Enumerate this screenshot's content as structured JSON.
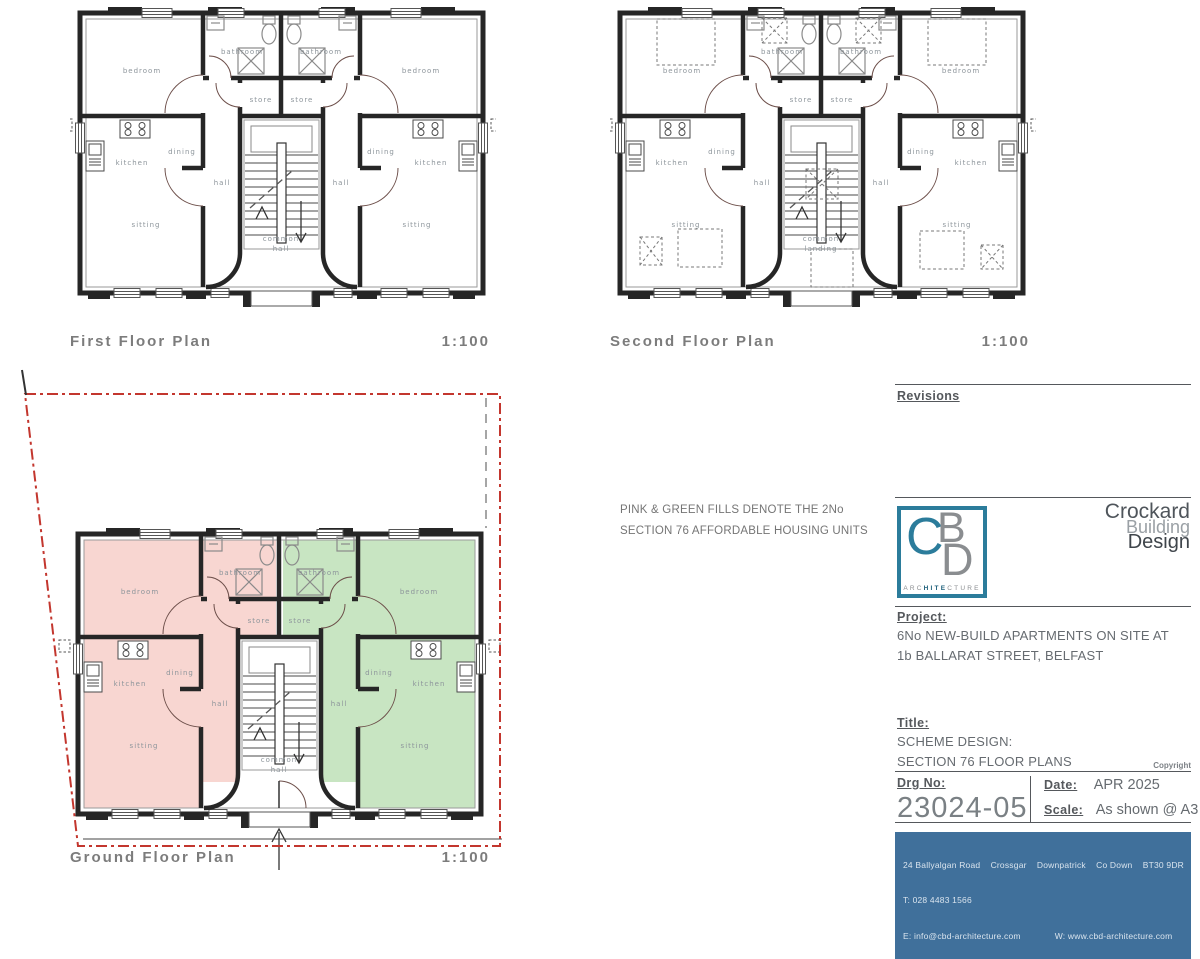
{
  "plans": {
    "first": {
      "title": "First Floor Plan",
      "scale": "1:100",
      "rooms": {
        "bedroom": "bedroom",
        "bathroom": "bathroom",
        "store": "store",
        "kitchen": "kitchen",
        "dining": "dining",
        "hall": "hall",
        "sitting": "sitting",
        "common_line1": "common",
        "common_line2": "hall"
      }
    },
    "second": {
      "title": "Second Floor Plan",
      "scale": "1:100",
      "rooms": {
        "bedroom": "bedroom",
        "bathroom": "bathroom",
        "store": "store",
        "kitchen": "kitchen",
        "dining": "dining",
        "hall": "hall",
        "sitting": "sitting",
        "common_line1": "common",
        "common_line2": "landing"
      }
    },
    "ground": {
      "title": "Ground Floor Plan",
      "scale": "1:100",
      "rooms": {
        "bedroom": "bedroom",
        "bathroom": "bathroom",
        "store": "store",
        "kitchen": "kitchen",
        "dining": "dining",
        "hall": "hall",
        "sitting": "sitting",
        "common_line1": "common",
        "common_line2": "hall"
      }
    }
  },
  "note": {
    "line1": "PINK & GREEN FILLS DENOTE THE 2No",
    "line2": "SECTION 76 AFFORDABLE HOUSING UNITS"
  },
  "title_block": {
    "revisions_label": "Revisions",
    "logo": {
      "letter_c": "C",
      "letter_b": "B",
      "letter_d": "D",
      "arch_pre": "ARC",
      "arch_mid": "HITE",
      "arch_post": "CTURE"
    },
    "company": {
      "line1": "Crockard",
      "line2": "Building",
      "line3": "Design"
    },
    "project_label": "Project:",
    "project_line1": "6No NEW-BUILD APARTMENTS ON SITE AT",
    "project_line2": "1b BALLARAT STREET, BELFAST",
    "title_label": "Title:",
    "title_line1": "SCHEME DESIGN:",
    "title_line2": "SECTION 76 FLOOR PLANS",
    "copyright": "Copyright",
    "drg_no_label": "Drg No:",
    "drg_no": "23024-05",
    "date_label": "Date:",
    "date_value": "APR 2025",
    "scale_label": "Scale:",
    "scale_value": "As shown @ A3",
    "footer": {
      "address": "24 Ballyalgan Road    Crossgar    Downpatrick    Co Down    BT30 9DR",
      "phone": "T: 028 4483 1566",
      "email": "E: info@cbd-architecture.com",
      "web": "W: www.cbd-architecture.com"
    }
  },
  "colors": {
    "pink": "#f8d6d1",
    "green": "#c8e5c2",
    "teal": "#2b7c9b",
    "red": "#c3362e",
    "footer_blue": "#40709b"
  }
}
